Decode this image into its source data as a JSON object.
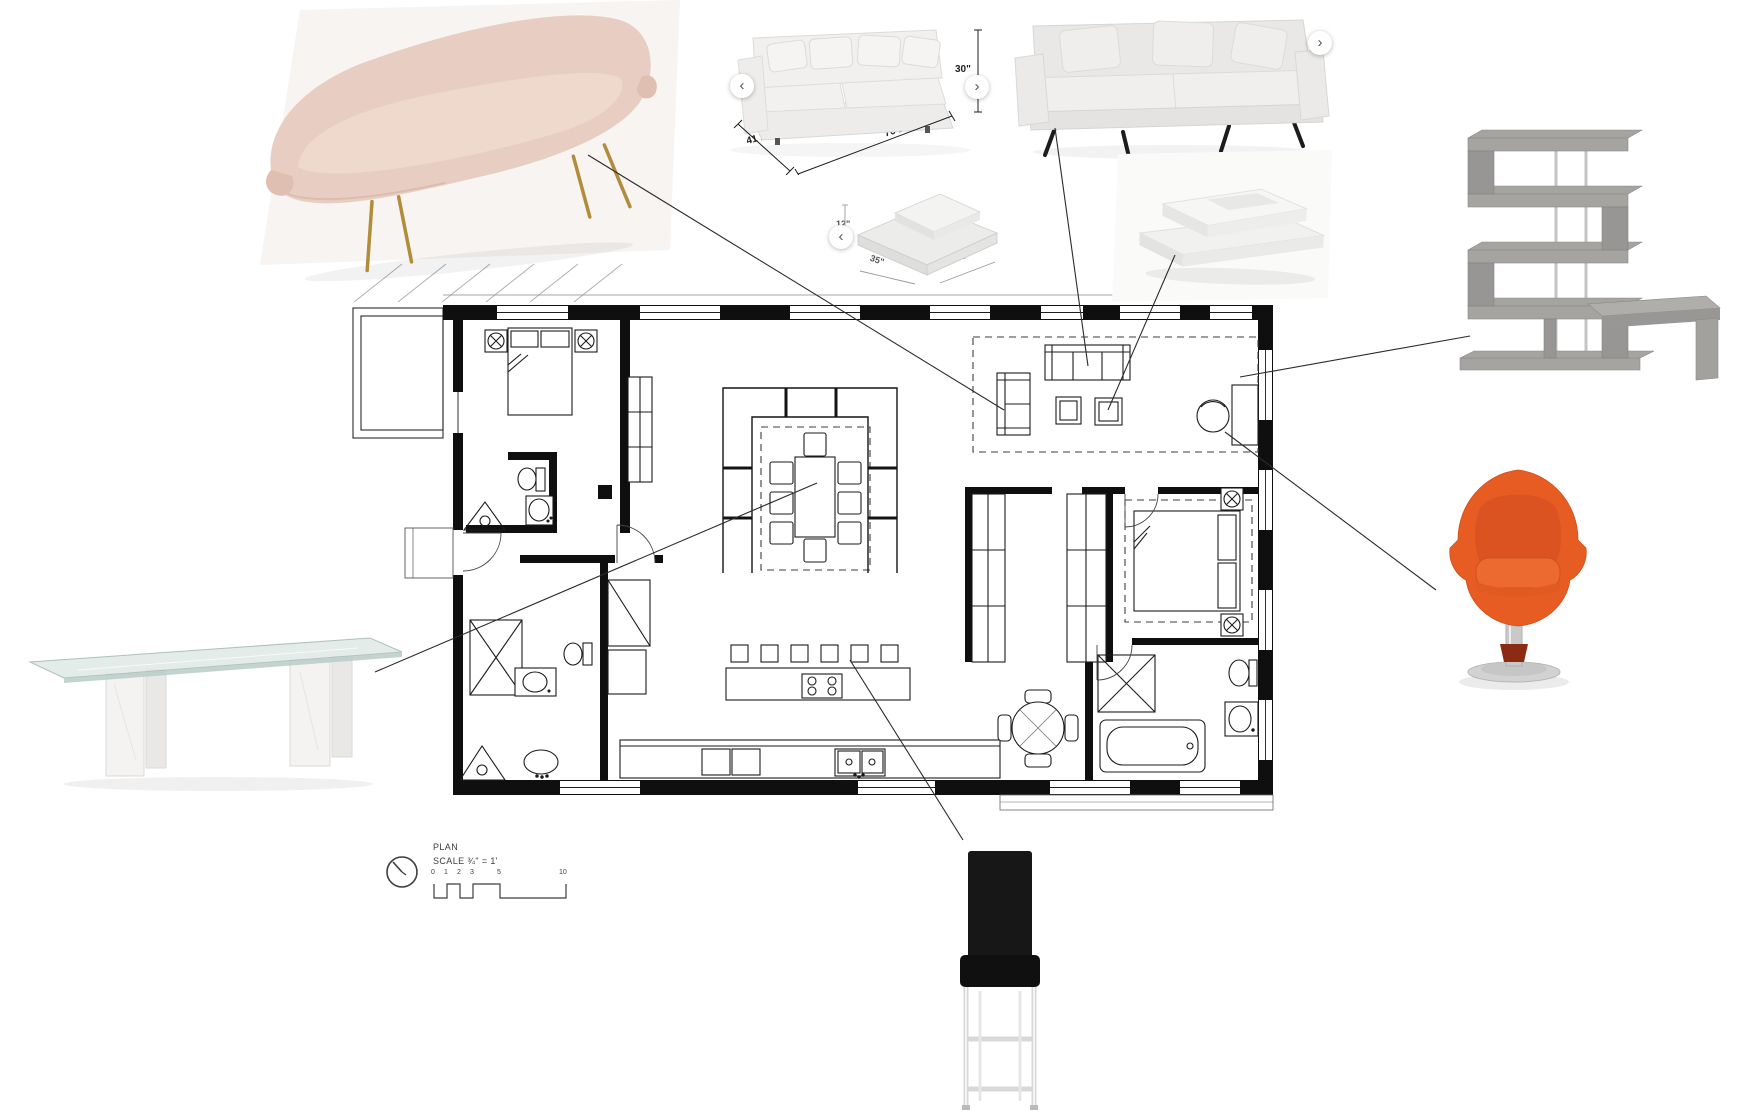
{
  "canvas": {
    "width": 1741,
    "height": 1119,
    "background": "#ffffff"
  },
  "products": {
    "sofa_carousel": {
      "depth_label": "41 1/4\"",
      "width_label": "76 1/2\"",
      "height_label": "30\"",
      "prev_glyph": "‹",
      "next_glyph": "›"
    },
    "sofa_plain": {
      "next_glyph": "›"
    },
    "coffee_table_carousel": {
      "height_label": "12\"",
      "width_label": "35\"",
      "depth_label": "35\"",
      "prev_glyph": "‹"
    }
  },
  "plan_legend": {
    "title": "PLAN",
    "scale_label": "SCALE ¾\" = 1'",
    "scale_ticks": [
      "0",
      "1",
      "2",
      "3",
      "5",
      "10"
    ]
  },
  "colors": {
    "accent_orange": "#e55a22",
    "blush": "#e8cec2",
    "wood_gray": "#a6a4a1",
    "line": "#2b2b2b"
  }
}
